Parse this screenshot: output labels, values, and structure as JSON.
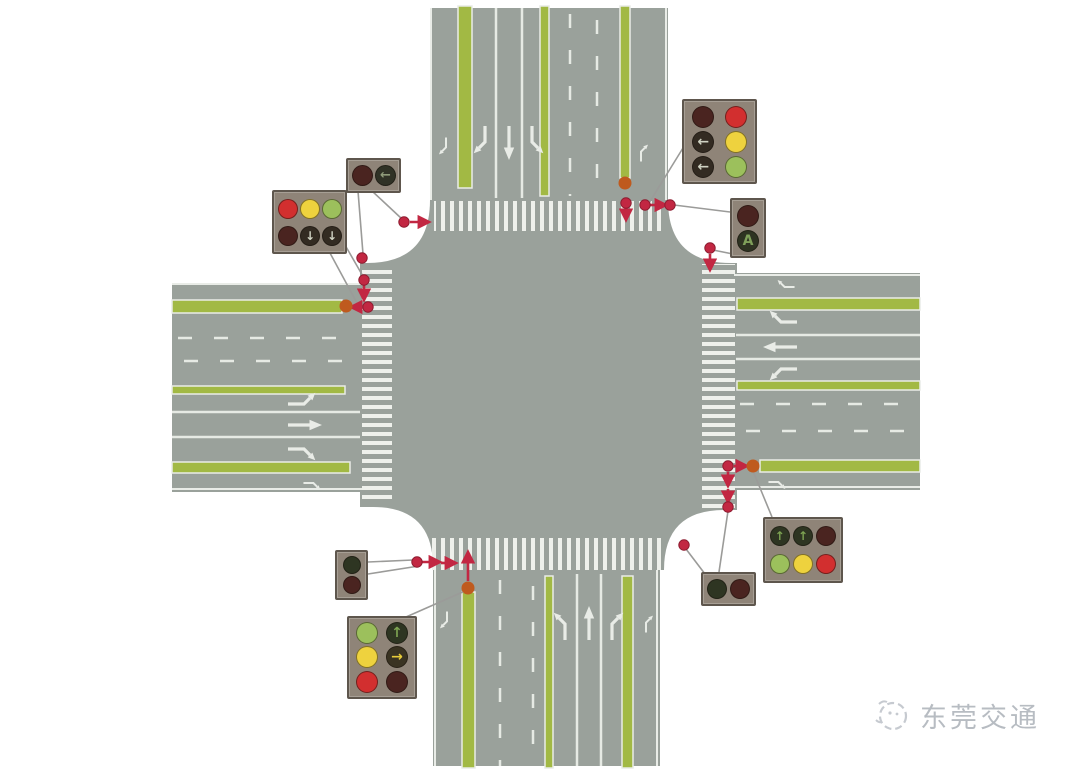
{
  "watermark": {
    "text": "东莞交通"
  },
  "palette": {
    "road_gray": "#9aa19b",
    "marking_white": "#e9ece7",
    "crosswalk_white": "#eef0eb",
    "median_green": "#a2b944",
    "connector_red": "#c22742",
    "median_tip_orange": "#bf5a1e",
    "leader_gray": "#9b9b99",
    "signal_housing": "#8f8478",
    "lit_red": "#d22f2f",
    "lit_yellow": "#eed23e",
    "lit_green": "#9cc05c",
    "off_red": "#4a2420",
    "off_green": "#2e3522",
    "off_dark": "#332b22",
    "watermark_gray": "#b7bcc2"
  },
  "signal_boxes": [
    {
      "name": "signal-box-topleft-pedestrian",
      "x": 346,
      "y": 158,
      "w": 55,
      "h": 35,
      "cols": 2,
      "d": 21,
      "lights": [
        {
          "fill": "#4a2420"
        },
        {
          "fill": "#303226",
          "glyph": "←",
          "glyph_color": "#8f9b7a"
        }
      ]
    },
    {
      "name": "signal-box-topleft-vehicle",
      "x": 272,
      "y": 190,
      "w": 75,
      "h": 64,
      "cols": 3,
      "d": 20,
      "lights": [
        {
          "fill": "#d22f2f"
        },
        {
          "fill": "#eed23e"
        },
        {
          "fill": "#9cc05c"
        },
        {
          "fill": "#4a2420"
        },
        {
          "fill": "#332b22",
          "glyph": "↓",
          "glyph_color": "#cfd2c2"
        },
        {
          "fill": "#332b22",
          "glyph": "↓",
          "glyph_color": "#cfd2c2"
        }
      ]
    },
    {
      "name": "signal-box-topright-vehicle",
      "x": 682,
      "y": 99,
      "w": 75,
      "h": 85,
      "cols": 2,
      "d": 22,
      "lights": [
        {
          "fill": "#4a2420"
        },
        {
          "fill": "#d22f2f"
        },
        {
          "fill": "#332b22",
          "glyph": "←",
          "glyph_color": "#cfd2c2"
        },
        {
          "fill": "#eed23e"
        },
        {
          "fill": "#332b22",
          "glyph": "←",
          "glyph_color": "#cfd2c2"
        },
        {
          "fill": "#9cc05c"
        }
      ]
    },
    {
      "name": "signal-box-topright-pedestrian",
      "x": 730,
      "y": 198,
      "w": 36,
      "h": 60,
      "cols": 1,
      "d": 22,
      "lights": [
        {
          "fill": "#4a2420"
        },
        {
          "fill": "#2e3322",
          "glyph": "A",
          "glyph_color": "#7fa05a"
        }
      ]
    },
    {
      "name": "signal-box-bottomleft-pedestrian",
      "x": 335,
      "y": 550,
      "w": 33,
      "h": 50,
      "cols": 1,
      "d": 18,
      "lights": [
        {
          "fill": "#2e3522"
        },
        {
          "fill": "#4a2420"
        }
      ]
    },
    {
      "name": "signal-box-bottomleft-vehicle",
      "x": 347,
      "y": 616,
      "w": 70,
      "h": 83,
      "cols": 2,
      "d": 22,
      "lights": [
        {
          "fill": "#9cc05c"
        },
        {
          "fill": "#2e3522",
          "glyph": "↑",
          "glyph_color": "#7da352"
        },
        {
          "fill": "#eed23e"
        },
        {
          "fill": "#3a3322",
          "glyph": "→",
          "glyph_color": "#e8cc3a"
        },
        {
          "fill": "#d22f2f"
        },
        {
          "fill": "#4a2420"
        }
      ]
    },
    {
      "name": "signal-box-bottomright-pedestrian",
      "x": 701,
      "y": 572,
      "w": 55,
      "h": 34,
      "cols": 2,
      "d": 20,
      "lights": [
        {
          "fill": "#2e3522"
        },
        {
          "fill": "#4a2420"
        }
      ]
    },
    {
      "name": "signal-box-bottomright-vehicle",
      "x": 763,
      "y": 517,
      "w": 80,
      "h": 66,
      "cols": 3,
      "d": 20,
      "lights": [
        {
          "fill": "#2e3522",
          "glyph": "↑",
          "glyph_color": "#7da352"
        },
        {
          "fill": "#2e3522",
          "glyph": "↑",
          "glyph_color": "#7da352"
        },
        {
          "fill": "#4a2420"
        },
        {
          "fill": "#9cc05c"
        },
        {
          "fill": "#eed23e"
        },
        {
          "fill": "#d22f2f"
        }
      ]
    }
  ],
  "roads": {
    "lane_arrows": [
      {
        "sym": "rt",
        "x": 485,
        "y": 143,
        "rot": 180,
        "s": 1
      },
      {
        "sym": "st",
        "x": 509,
        "y": 143,
        "rot": 180,
        "s": 1
      },
      {
        "sym": "lt",
        "x": 532,
        "y": 143,
        "rot": 180,
        "s": 1
      },
      {
        "sym": "rt",
        "x": 446,
        "y": 148,
        "rot": 180,
        "s": 0.62
      },
      {
        "sym": "rt",
        "x": 641,
        "y": 151,
        "rot": 0,
        "s": 0.62
      },
      {
        "sym": "lt",
        "x": 565,
        "y": 623,
        "rot": 0,
        "s": 1
      },
      {
        "sym": "st",
        "x": 589,
        "y": 623,
        "rot": 0,
        "s": 1
      },
      {
        "sym": "rt",
        "x": 612,
        "y": 623,
        "rot": 0,
        "s": 1
      },
      {
        "sym": "rt",
        "x": 447,
        "y": 622,
        "rot": 180,
        "s": 0.62
      },
      {
        "sym": "rt",
        "x": 646,
        "y": 622,
        "rot": 0,
        "s": 0.62
      },
      {
        "sym": "lt",
        "x": 305,
        "y": 404,
        "rot": 90,
        "s": 1
      },
      {
        "sym": "st",
        "x": 305,
        "y": 425,
        "rot": 90,
        "s": 1
      },
      {
        "sym": "rt",
        "x": 305,
        "y": 449,
        "rot": 90,
        "s": 1
      },
      {
        "sym": "rt",
        "x": 314,
        "y": 483,
        "rot": 90,
        "s": 0.62
      },
      {
        "sym": "rt",
        "x": 780,
        "y": 322,
        "rot": -90,
        "s": 1
      },
      {
        "sym": "st",
        "x": 780,
        "y": 347,
        "rot": -90,
        "s": 1
      },
      {
        "sym": "lt",
        "x": 780,
        "y": 369,
        "rot": -90,
        "s": 1
      },
      {
        "sym": "rt",
        "x": 784,
        "y": 287,
        "rot": -90,
        "s": 0.62
      },
      {
        "sym": "rt",
        "x": 779,
        "y": 482,
        "rot": 90,
        "s": 0.62
      }
    ]
  },
  "overlay": {
    "leader_lines": [
      {
        "x1": 372,
        "y1": 191,
        "x2": 402,
        "y2": 219
      },
      {
        "x1": 358,
        "y1": 191,
        "x2": 363,
        "y2": 254
      },
      {
        "x1": 345,
        "y1": 245,
        "x2": 364,
        "y2": 278
      },
      {
        "x1": 330,
        "y1": 253,
        "x2": 357,
        "y2": 303
      },
      {
        "x1": 683,
        "y1": 148,
        "x2": 649,
        "y2": 203
      },
      {
        "x1": 730,
        "y1": 212,
        "x2": 674,
        "y2": 205
      },
      {
        "x1": 738,
        "y1": 255,
        "x2": 713,
        "y2": 250
      },
      {
        "x1": 368,
        "y1": 562,
        "x2": 413,
        "y2": 560
      },
      {
        "x1": 368,
        "y1": 574,
        "x2": 419,
        "y2": 566
      },
      {
        "x1": 406,
        "y1": 617,
        "x2": 465,
        "y2": 591
      },
      {
        "x1": 719,
        "y1": 572,
        "x2": 728,
        "y2": 511
      },
      {
        "x1": 705,
        "y1": 574,
        "x2": 686,
        "y2": 549
      },
      {
        "x1": 772,
        "y1": 517,
        "x2": 753,
        "y2": 471
      }
    ],
    "red_arrows": [
      {
        "x1": 410,
        "y1": 222,
        "x2": 429,
        "y2": 222
      },
      {
        "x1": 364,
        "y1": 285,
        "x2": 364,
        "y2": 300
      },
      {
        "x1": 362,
        "y1": 307,
        "x2": 351,
        "y2": 307
      },
      {
        "x1": 626,
        "y1": 208,
        "x2": 626,
        "y2": 220
      },
      {
        "x1": 650,
        "y1": 205,
        "x2": 666,
        "y2": 205
      },
      {
        "x1": 710,
        "y1": 254,
        "x2": 710,
        "y2": 270
      },
      {
        "x1": 422,
        "y1": 562,
        "x2": 440,
        "y2": 562
      },
      {
        "x1": 441,
        "y1": 563,
        "x2": 456,
        "y2": 563
      },
      {
        "x1": 468,
        "y1": 581,
        "x2": 468,
        "y2": 552
      },
      {
        "x1": 734,
        "y1": 466,
        "x2": 747,
        "y2": 466
      },
      {
        "x1": 728,
        "y1": 472,
        "x2": 728,
        "y2": 486
      },
      {
        "x1": 728,
        "y1": 489,
        "x2": 728,
        "y2": 502
      }
    ],
    "red_dots": [
      {
        "x": 404,
        "y": 222
      },
      {
        "x": 362,
        "y": 258
      },
      {
        "x": 364,
        "y": 280
      },
      {
        "x": 368,
        "y": 307
      },
      {
        "x": 626,
        "y": 203
      },
      {
        "x": 645,
        "y": 205
      },
      {
        "x": 670,
        "y": 205
      },
      {
        "x": 710,
        "y": 248
      },
      {
        "x": 417,
        "y": 562
      },
      {
        "x": 728,
        "y": 466
      },
      {
        "x": 728,
        "y": 507
      },
      {
        "x": 684,
        "y": 545
      }
    ],
    "median_tips": [
      {
        "x": 625,
        "y": 183
      },
      {
        "x": 346,
        "y": 306
      },
      {
        "x": 468,
        "y": 588
      },
      {
        "x": 753,
        "y": 466
      }
    ]
  }
}
